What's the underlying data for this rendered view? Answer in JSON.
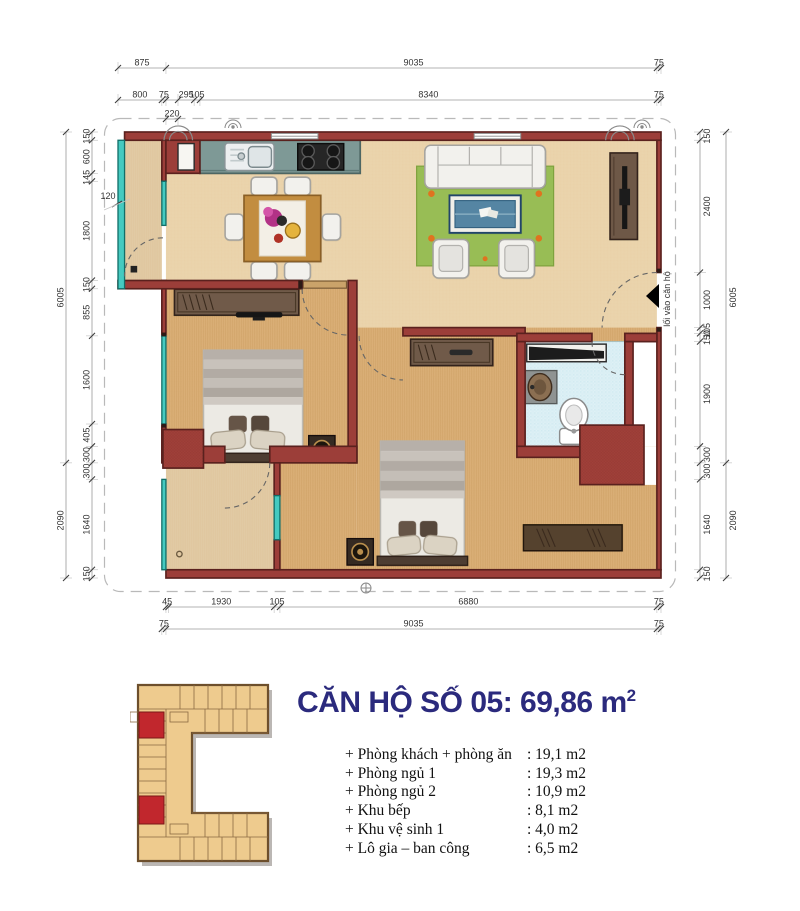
{
  "header": {
    "title_main": "CĂN HỘ SỐ 05: 69,86 m",
    "title_sup": "2"
  },
  "rooms": [
    {
      "label": "+ Phòng khách + phòng ăn",
      "value": ": 19,1 m2"
    },
    {
      "label": "+ Phòng ngủ 1",
      "value": ": 19,3 m2"
    },
    {
      "label": "+ Phòng ngủ 2",
      "value": ": 10,9 m2"
    },
    {
      "label": "+ Khu bếp",
      "value": ": 8,1 m2"
    },
    {
      "label": "+ Khu vệ sinh 1",
      "value": ": 4,0 m2"
    },
    {
      "label": "+ Lô gia – ban công",
      "value": ": 6,5 m2"
    }
  ],
  "plan": {
    "entrance_label": "lối vào căn hộ",
    "wall_note": "120",
    "scale": {
      "x0": 118,
      "y0": 132,
      "sx": 0.054793,
      "sy": 0.055096
    },
    "dim_chains": [
      {
        "o": "h",
        "pos": 68,
        "segs": [
          [
            0,
            875,
            "875"
          ],
          [
            875,
            9910,
            "9035"
          ],
          [
            9835,
            9910,
            "75"
          ]
        ]
      },
      {
        "o": "h",
        "pos": 100,
        "segs": [
          [
            0,
            800,
            "800"
          ],
          [
            800,
            875,
            "75"
          ],
          [
            1095,
            1390,
            "295"
          ],
          [
            1390,
            1495,
            "105"
          ],
          [
            1495,
            9835,
            "8340"
          ],
          [
            9835,
            9910,
            "75"
          ]
        ]
      },
      {
        "o": "h",
        "pos": 119,
        "segs": [
          [
            875,
            1095,
            "220"
          ]
        ]
      },
      {
        "o": "h",
        "pos": 607,
        "segs": [
          [
            875,
            920,
            "45"
          ],
          [
            920,
            2850,
            "1930"
          ],
          [
            2850,
            2955,
            "105"
          ],
          [
            2955,
            9835,
            "6880"
          ],
          [
            9835,
            9910,
            "75"
          ]
        ]
      },
      {
        "o": "h",
        "pos": 629,
        "segs": [
          [
            800,
            875,
            "75"
          ],
          [
            875,
            9910,
            "9035"
          ],
          [
            9835,
            9910,
            "75"
          ]
        ]
      },
      {
        "o": "v",
        "pos": 66,
        "side": "l",
        "segs": [
          [
            0,
            6005,
            "6005"
          ],
          [
            6005,
            8095,
            "2090"
          ]
        ]
      },
      {
        "o": "v",
        "pos": 92,
        "side": "l",
        "segs": [
          [
            0,
            150,
            "150"
          ],
          [
            150,
            750,
            "600"
          ],
          [
            750,
            895,
            "145"
          ],
          [
            895,
            2695,
            "1800"
          ],
          [
            2695,
            2845,
            "150"
          ],
          [
            2845,
            3700,
            "855"
          ],
          [
            3700,
            5300,
            "1600"
          ],
          [
            5300,
            5705,
            "405"
          ],
          [
            5705,
            6005,
            "300"
          ],
          [
            6005,
            6305,
            "300"
          ],
          [
            6305,
            7945,
            "1640"
          ],
          [
            7945,
            8095,
            "150"
          ]
        ]
      },
      {
        "o": "v",
        "pos": 700,
        "side": "r",
        "segs": [
          [
            0,
            150,
            "150"
          ],
          [
            150,
            2550,
            "2400"
          ],
          [
            2550,
            3550,
            "1000"
          ],
          [
            3550,
            3655,
            "105"
          ],
          [
            3655,
            3805,
            "150"
          ],
          [
            3805,
            5705,
            "1900"
          ],
          [
            5705,
            6005,
            "300"
          ],
          [
            6005,
            6305,
            "300"
          ],
          [
            6305,
            7945,
            "1640"
          ],
          [
            7945,
            8095,
            "150"
          ]
        ]
      },
      {
        "o": "v",
        "pos": 726,
        "side": "r",
        "segs": [
          [
            0,
            6005,
            "6005"
          ],
          [
            6005,
            8095,
            "2090"
          ]
        ]
      }
    ]
  },
  "colors": {
    "wall": "#9c3e39",
    "wall_outline": "#5a211e",
    "glass": "#45cac0",
    "tile": "#e9d1a8",
    "wood": "#d9ae74",
    "stone": "#dcc094",
    "bath_tile": "#abd9e6",
    "rug": "#98bd55",
    "counter": "#7e9996",
    "title": "#2b2a7d",
    "unit_highlight": "#c1272d",
    "building": "#eecb8e"
  }
}
